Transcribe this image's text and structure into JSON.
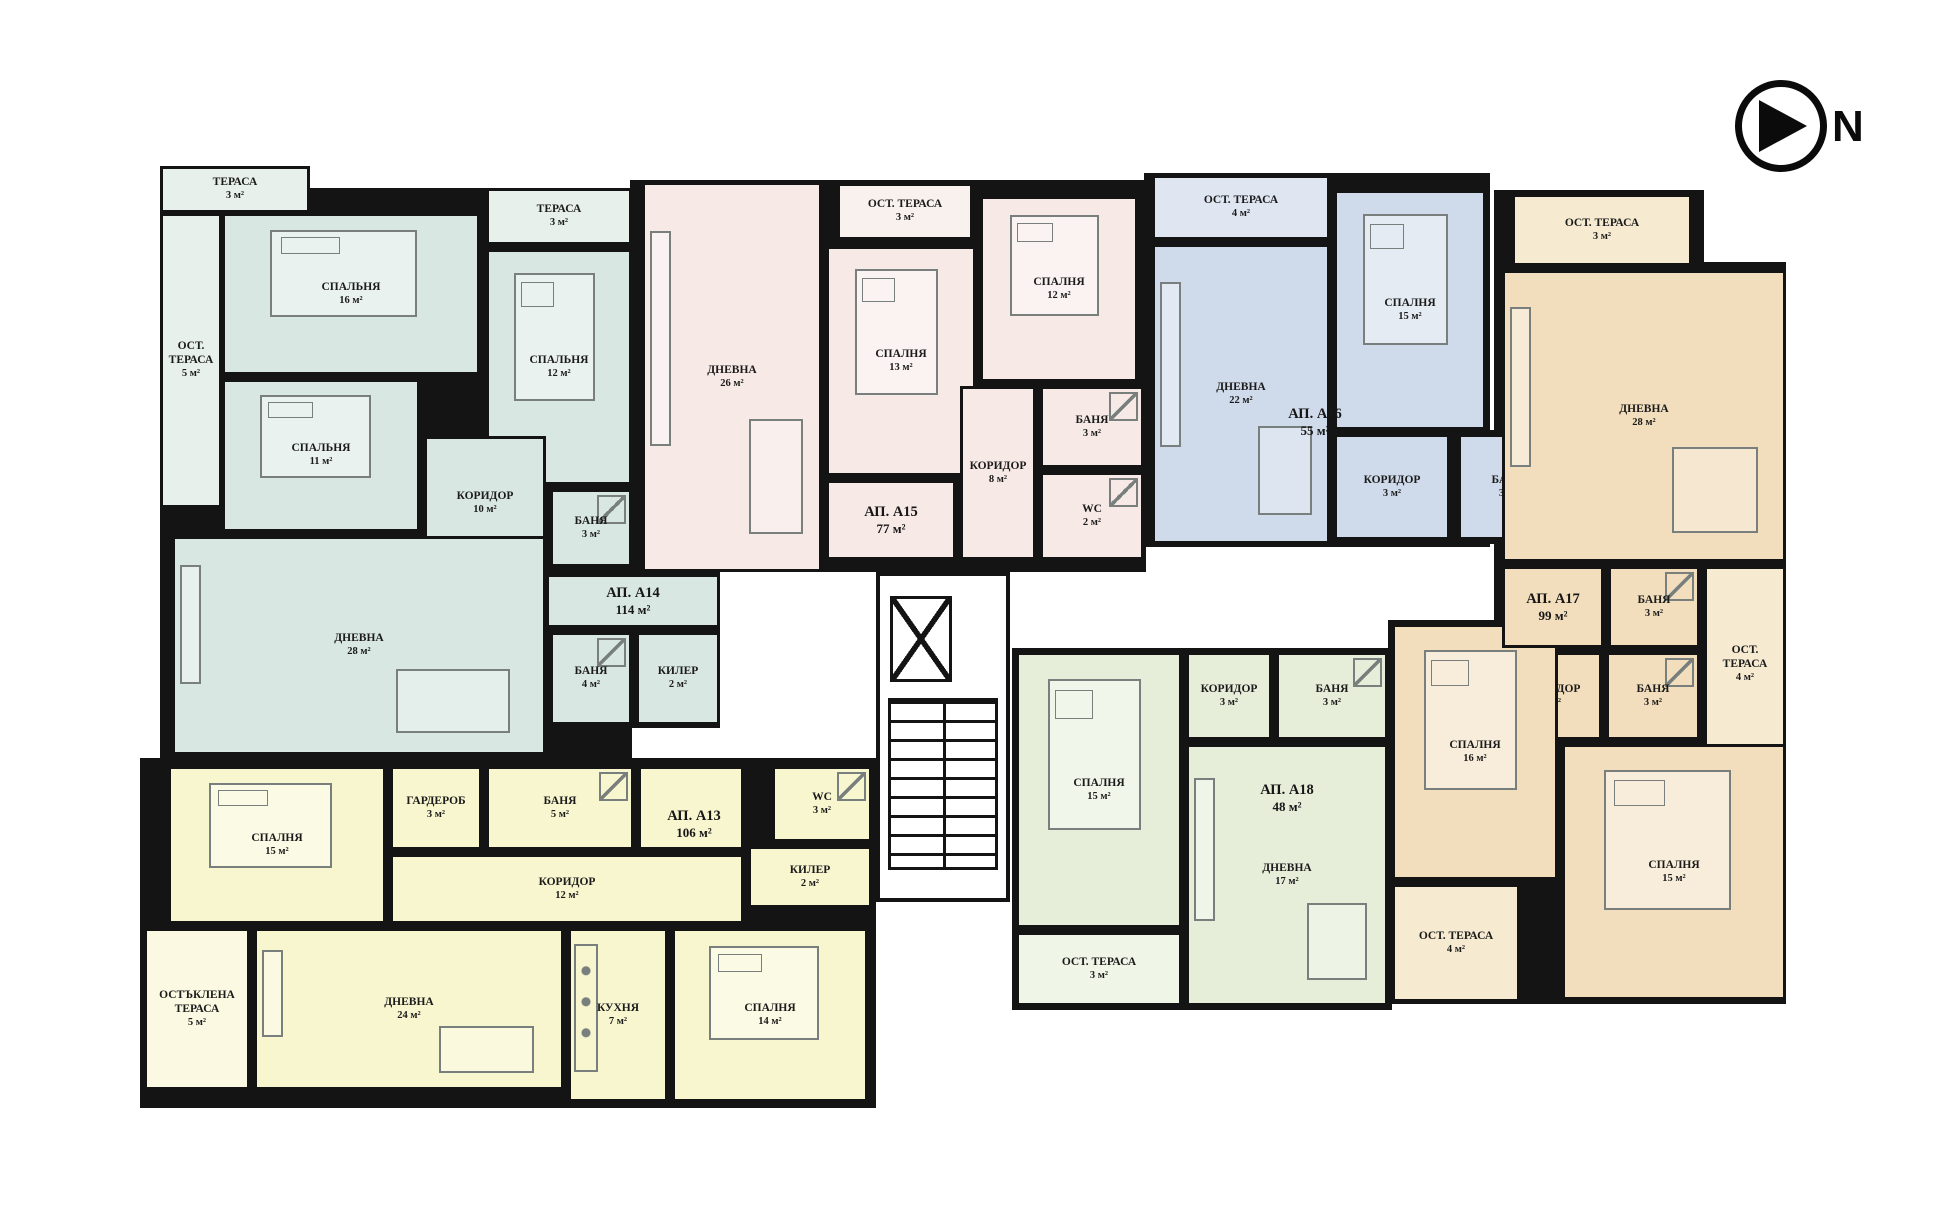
{
  "compass": {
    "label": "N"
  },
  "wall_color": "#141414",
  "apartments": [
    {
      "id": "a14",
      "label": "АП. А14",
      "area": "114 м²",
      "color": "#d9e7e2",
      "terrace_color": "#e8f0ec",
      "label_box": [
        546,
        576,
        174,
        50
      ],
      "shells": [
        [
          160,
          188,
          472,
          570
        ],
        [
          546,
          570,
          174,
          158
        ],
        [
          160,
          166,
          150,
          47
        ]
      ],
      "rooms": [
        {
          "id": "terasa-1",
          "name": "ТЕРАСА",
          "area": "3 м²",
          "box": [
            160,
            166,
            150,
            47
          ],
          "terrace": true
        },
        {
          "id": "ost-terasa-5",
          "name": "ОСТ. ТЕРАСА",
          "area": "5 м²",
          "box": [
            160,
            213,
            62,
            295
          ],
          "terrace": true
        },
        {
          "id": "spalnya-16",
          "name": "СПАЛЬНЯ",
          "area": "16 м²",
          "box": [
            222,
            213,
            258,
            162
          ],
          "furn": "bed"
        },
        {
          "id": "spalnya-11",
          "name": "СПАЛЬНЯ",
          "area": "11 м²",
          "box": [
            222,
            379,
            198,
            153
          ],
          "furn": "bed"
        },
        {
          "id": "terasa-2",
          "name": "ТЕРАСА",
          "area": "3 м²",
          "box": [
            486,
            188,
            146,
            57
          ],
          "terrace": true
        },
        {
          "id": "spalnya-12",
          "name": "СПАЛЬНЯ",
          "area": "12 м²",
          "box": [
            486,
            249,
            146,
            236
          ],
          "furn": "bed"
        },
        {
          "id": "koridor-10",
          "name": "КОРИДОР",
          "area": "10 м²",
          "box": [
            424,
            436,
            122,
            134
          ]
        },
        {
          "id": "banya-3",
          "name": "БАНЯ",
          "area": "3 м²",
          "box": [
            550,
            489,
            82,
            78
          ],
          "furn": "shower"
        },
        {
          "id": "dnevna-28",
          "name": "ДНЕВНА",
          "area": "28 м²",
          "box": [
            172,
            536,
            374,
            219
          ],
          "furn": "living"
        },
        {
          "id": "banya-4",
          "name": "БАНЯ",
          "area": "4 м²",
          "box": [
            550,
            632,
            82,
            93
          ],
          "furn": "shower"
        },
        {
          "id": "kiler-2",
          "name": "КИЛЕР",
          "area": "2 м²",
          "box": [
            636,
            632,
            84,
            93
          ]
        },
        {
          "id": "hall",
          "name": "",
          "area": "",
          "box": [
            546,
            574,
            174,
            54
          ]
        }
      ]
    },
    {
      "id": "a15",
      "label": "АП. А15",
      "area": "77 м²",
      "color": "#f6e9e6",
      "terrace_color": "#f9f1ee",
      "label_box": [
        830,
        490,
        122,
        60
      ],
      "shells": [
        [
          630,
          180,
          516,
          392
        ]
      ],
      "rooms": [
        {
          "id": "dnevna-26",
          "name": "ДНЕВНА",
          "area": "26 м²",
          "box": [
            642,
            182,
            180,
            390
          ],
          "furn": "living"
        },
        {
          "id": "ost-terasa-3",
          "name": "ОСТ. ТЕРАСА",
          "area": "3 м²",
          "box": [
            837,
            183,
            136,
            57
          ],
          "terrace": true
        },
        {
          "id": "spalnya-13",
          "name": "СПАЛНЯ",
          "area": "13 м²",
          "box": [
            826,
            246,
            150,
            230
          ],
          "furn": "bed"
        },
        {
          "id": "spalnya-12",
          "name": "СПАЛНЯ",
          "area": "12 м²",
          "box": [
            980,
            196,
            158,
            186
          ],
          "furn": "bed"
        },
        {
          "id": "koridor-8",
          "name": "КОРИДОР",
          "area": "8 м²",
          "box": [
            960,
            386,
            76,
            174
          ]
        },
        {
          "id": "banya-3",
          "name": "БАНЯ",
          "area": "3 м²",
          "box": [
            1040,
            386,
            104,
            82
          ],
          "furn": "shower"
        },
        {
          "id": "wc-2",
          "name": "WC",
          "area": "2 м²",
          "box": [
            1040,
            472,
            104,
            88
          ],
          "furn": "shower"
        },
        {
          "id": "hall",
          "name": "",
          "area": "",
          "box": [
            826,
            480,
            130,
            80
          ]
        }
      ]
    },
    {
      "id": "a16",
      "label": "АП. А16",
      "area": "55 м²",
      "color": "#cfdaea",
      "terrace_color": "#dfe6f2",
      "label_box": [
        1240,
        398,
        150,
        48
      ],
      "shells": [
        [
          1144,
          173,
          346,
          374
        ],
        [
          1454,
          430,
          108,
          114
        ]
      ],
      "rooms": [
        {
          "id": "ost-terasa-4",
          "name": "ОСТ. ТЕРАСА",
          "area": "4 м²",
          "box": [
            1152,
            175,
            178,
            65
          ],
          "terrace": true
        },
        {
          "id": "dnevna-22",
          "name": "ДНЕВНА",
          "area": "22 м²",
          "box": [
            1152,
            244,
            178,
            300
          ],
          "furn": "living"
        },
        {
          "id": "spalnya-15",
          "name": "СПАЛНЯ",
          "area": "15 м²",
          "box": [
            1334,
            190,
            152,
            240
          ],
          "furn": "bed"
        },
        {
          "id": "koridor-3",
          "name": "КОРИДОР",
          "area": "3 м²",
          "box": [
            1334,
            434,
            116,
            106
          ]
        },
        {
          "id": "banya-3",
          "name": "БАНЯ",
          "area": "3 м²",
          "box": [
            1458,
            434,
            100,
            106
          ],
          "furn": "shower"
        }
      ]
    },
    {
      "id": "a17",
      "label": "АП. А17",
      "area": "99 м²",
      "color": "#f2debc",
      "terrace_color": "#f6ead1",
      "label_box": [
        1498,
        578,
        110,
        58
      ],
      "shells": [
        [
          1494,
          190,
          210,
          380
        ],
        [
          1494,
          262,
          292,
          308
        ],
        [
          1494,
          562,
          292,
          200
        ],
        [
          1388,
          620,
          398,
          384
        ]
      ],
      "rooms": [
        {
          "id": "ost-terasa-3",
          "name": "ОСТ. ТЕРАСА",
          "area": "3 м²",
          "box": [
            1512,
            194,
            180,
            72
          ],
          "terrace": true
        },
        {
          "id": "dnevna-28",
          "name": "ДНЕВНА",
          "area": "28 м²",
          "box": [
            1502,
            270,
            284,
            292
          ],
          "furn": "living"
        },
        {
          "id": "banya-3-upper",
          "name": "БАНЯ",
          "area": "3 м²",
          "box": [
            1608,
            566,
            92,
            82
          ],
          "furn": "shower"
        },
        {
          "id": "ost-terasa-4-right",
          "name": "ОСТ. ТЕРАСА",
          "area": "4 м²",
          "box": [
            1704,
            566,
            82,
            196
          ],
          "terrace": true
        },
        {
          "id": "koridor-7",
          "name": "КОРИДОР",
          "area": "7 м²",
          "box": [
            1502,
            652,
            100,
            88
          ]
        },
        {
          "id": "banya-3-lower",
          "name": "БАНЯ",
          "area": "3 м²",
          "box": [
            1606,
            652,
            94,
            88
          ],
          "furn": "shower"
        },
        {
          "id": "spalnya-16",
          "name": "СПАЛНЯ",
          "area": "16 м²",
          "box": [
            1392,
            624,
            166,
            256
          ],
          "furn": "bed"
        },
        {
          "id": "spalnya-15",
          "name": "СПАЛНЯ",
          "area": "15 м²",
          "box": [
            1562,
            744,
            224,
            256
          ],
          "furn": "bed"
        },
        {
          "id": "ost-terasa-4-bottom",
          "name": "ОСТ. ТЕРАСА",
          "area": "4 м²",
          "box": [
            1392,
            884,
            128,
            118
          ],
          "terrace": true
        },
        {
          "id": "hall",
          "name": "",
          "area": "",
          "box": [
            1502,
            566,
            102,
            82
          ]
        }
      ]
    },
    {
      "id": "a13",
      "label": "АП. А13",
      "area": "106 м²",
      "color": "#f8f6cf",
      "terrace_color": "#fbf9e2",
      "label_box": [
        644,
        800,
        100,
        48
      ],
      "shells": [
        [
          140,
          758,
          736,
          350
        ]
      ],
      "rooms": [
        {
          "id": "spalnya-15",
          "name": "СПАЛНЯ",
          "area": "15 м²",
          "box": [
            168,
            766,
            218,
            158
          ],
          "furn": "bed"
        },
        {
          "id": "garderob-3",
          "name": "ГАРДЕРОБ",
          "area": "3 м²",
          "box": [
            390,
            766,
            92,
            84
          ]
        },
        {
          "id": "banya-5",
          "name": "БАНЯ",
          "area": "5 м²",
          "box": [
            486,
            766,
            148,
            84
          ],
          "furn": "shower"
        },
        {
          "id": "wc-3",
          "name": "WC",
          "area": "3 м²",
          "box": [
            772,
            766,
            100,
            76
          ],
          "furn": "shower"
        },
        {
          "id": "kiler-2",
          "name": "КИЛЕР",
          "area": "2 м²",
          "box": [
            748,
            846,
            124,
            62
          ]
        },
        {
          "id": "koridor-12",
          "name": "КОРИДОР",
          "area": "12 м²",
          "box": [
            390,
            854,
            354,
            70
          ]
        },
        {
          "id": "ostaklena-terasa-5",
          "name": "ОСТЪКЛЕНА ТЕРАСА",
          "area": "5 м²",
          "box": [
            144,
            928,
            106,
            162
          ],
          "terrace": true
        },
        {
          "id": "dnevna-24",
          "name": "ДНЕВНА",
          "area": "24 м²",
          "box": [
            254,
            928,
            310,
            162
          ],
          "furn": "living"
        },
        {
          "id": "kuhnya-7",
          "name": "КУХНЯ",
          "area": "7 м²",
          "box": [
            568,
            928,
            100,
            174
          ],
          "furn": "kitchen"
        },
        {
          "id": "spalnya-14",
          "name": "СПАЛНЯ",
          "area": "14 м²",
          "box": [
            672,
            928,
            196,
            174
          ],
          "furn": "bed"
        },
        {
          "id": "hall",
          "name": "",
          "area": "",
          "box": [
            638,
            766,
            106,
            84
          ]
        }
      ]
    },
    {
      "id": "a18",
      "label": "АП. А18",
      "area": "48 м²",
      "color": "#e6eeda",
      "terrace_color": "#eff5e7",
      "label_box": [
        1212,
        774,
        150,
        48
      ],
      "shells": [
        [
          1012,
          648,
          380,
          362
        ]
      ],
      "rooms": [
        {
          "id": "spalnya-15",
          "name": "СПАЛНЯ",
          "area": "15 м²",
          "box": [
            1016,
            652,
            166,
            276
          ],
          "furn": "bed"
        },
        {
          "id": "koridor-3",
          "name": "КОРИДОР",
          "area": "3 м²",
          "box": [
            1186,
            652,
            86,
            88
          ]
        },
        {
          "id": "banya-3",
          "name": "БАНЯ",
          "area": "3 м²",
          "box": [
            1276,
            652,
            112,
            88
          ],
          "furn": "shower"
        },
        {
          "id": "dnevna-17",
          "name": "ДНЕВНА",
          "area": "17 м²",
          "box": [
            1186,
            744,
            202,
            262
          ],
          "furn": "living"
        },
        {
          "id": "ost-terasa-3",
          "name": "ОСТ. ТЕРАСА",
          "area": "3 м²",
          "box": [
            1016,
            932,
            166,
            74
          ],
          "terrace": true
        }
      ]
    }
  ]
}
